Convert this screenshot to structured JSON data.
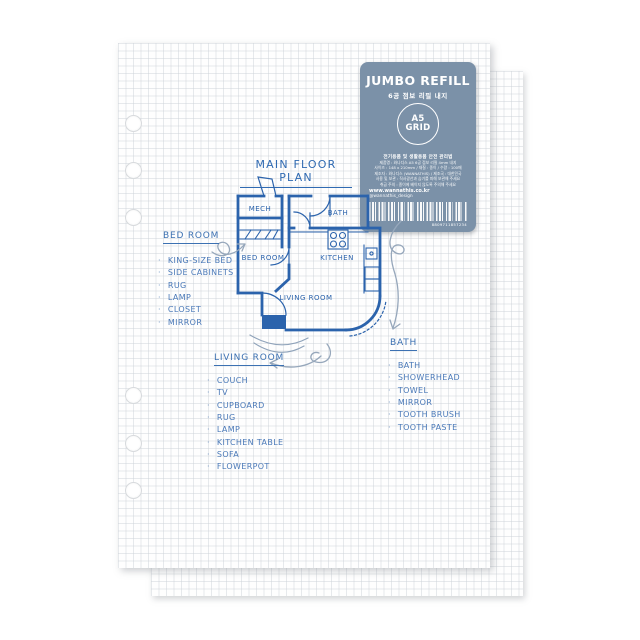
{
  "label": {
    "title": "JUMBO REFILL",
    "subtitle": "6공 점보 리필 내지",
    "badge_line1": "A5",
    "badge_line2": "GRID",
    "info_heading": "전기용품 및 생활용품 안전 관리법",
    "info_lines": [
      "제품명 : 와나디스 A5 6공 점보 리필 4mm 내지",
      "사이즈 : 148 x 210mm / 재질 : 종이 / 수량 : 100매",
      "제조자 : 와나디스 (WANNATHIS) / 제조국 : 대한민국",
      "사용 및 보관 : 직사광선과 습기를 피해 보관해 주세요",
      "취급 주의 : 종이에 베이지 않도록 주의해 주세요"
    ],
    "website": "www.wannathis.co.kr",
    "instagram": "@wannathis_design",
    "barcode_number": "8809711857234",
    "color": "#7b91a8"
  },
  "sketch": {
    "heading": "MAIN FLOOR PLAN",
    "ink_color": "#2b63ac",
    "rooms": {
      "mech": "MECH",
      "bath": "BATH",
      "bedroom": "BED ROOM",
      "kitchen": "KITCHEN",
      "living": "LIVING ROOM"
    },
    "sections": [
      {
        "heading": "BED ROOM",
        "items": [
          "KING-SIZE BED",
          "SIDE CABINETS",
          "RUG",
          "LAMP",
          "CLOSET",
          "MIRROR"
        ]
      },
      {
        "heading": "LIVING ROOM",
        "items": [
          "COUCH",
          "TV",
          "CUPBOARD",
          "RUG",
          "LAMP",
          "KITCHEN TABLE",
          "SOFA",
          "FLOWERPOT"
        ]
      },
      {
        "heading": "BATH",
        "items": [
          "BATH",
          "SHOWERHEAD",
          "TOWEL",
          "MIRROR",
          "TOOTH BRUSH",
          "TOOTH PASTE"
        ]
      }
    ]
  }
}
